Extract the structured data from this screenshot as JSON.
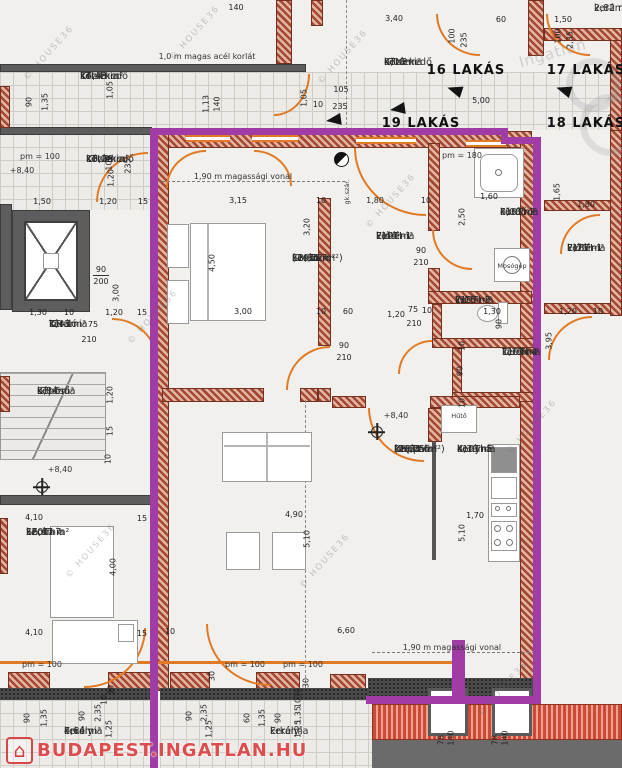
{
  "colors": {
    "purple": "#a13ba5",
    "wall_brick": "#a34832",
    "door_orange": "#e07a25",
    "banner_red": "#d52626"
  },
  "watermarks": {
    "house36": {
      "text": "© HOUSE36",
      "positions": [
        {
          "x": 14,
          "y": 48
        },
        {
          "x": 160,
          "y": 28
        },
        {
          "x": 308,
          "y": 52
        },
        {
          "x": 356,
          "y": 196
        },
        {
          "x": 118,
          "y": 312
        },
        {
          "x": 497,
          "y": 422
        },
        {
          "x": 56,
          "y": 546
        },
        {
          "x": 290,
          "y": 556
        },
        {
          "x": 468,
          "y": 684
        }
      ]
    },
    "portal": {
      "text": "Ingatlan"
    },
    "banner": {
      "icon": "⌂",
      "text": "BUDAPEST.INGATLAN.HU"
    }
  },
  "plan": {
    "units": [
      {
        "label": "16 LAKÁS",
        "x": 466,
        "y": 63
      },
      {
        "label": "17 LAKÁS",
        "x": 586,
        "y": 63
      },
      {
        "label": "19 LAKÁS",
        "x": 421,
        "y": 116
      },
      {
        "label": "18 LAKÁS",
        "x": 586,
        "y": 116
      }
    ],
    "rooms": [
      {
        "id": "KTI-4",
        "name": "Közlekedő",
        "mat": "kerámia",
        "area": "14,43 m²",
        "x": 80,
        "y": 70
      },
      {
        "id": "KTI-2",
        "name": "Közlekedő",
        "mat": "kerámia",
        "area": "10,28 m²",
        "x": 86,
        "y": 153
      },
      {
        "id": "KTI-3",
        "name": "Közlekedő",
        "mat": "kerámia",
        "area": "6,00 m²",
        "x": 384,
        "y": 56
      },
      {
        "id": "KTI-1",
        "name": "Tároló",
        "mat": "kerámia",
        "area": "1,43 m²",
        "x": 49,
        "y": 318
      },
      {
        "id": "KTI-6",
        "name": "Lépcső",
        "mat": "kerámia",
        "area": "6,84 m²",
        "x": 37,
        "y": 385
      },
      {
        "id": "L19TI-7",
        "name": "Szoba",
        "mat": "kerámia",
        "area": "13,36 m²",
        "area2": "(14,22 m²)",
        "x": 292,
        "y": 252
      },
      {
        "id": "L19TI-1",
        "name": "Előtér",
        "mat": "kerámia",
        "area": "7,44 m²",
        "x": 376,
        "y": 230
      },
      {
        "id": "L19TI-2",
        "name": "Fürdő",
        "mat": "kerámia",
        "area": "4,00 m²",
        "x": 500,
        "y": 206
      },
      {
        "id": "L19TI-3",
        "name": "WC",
        "mat": "kerámia",
        "area": "1,15 m²",
        "x": 455,
        "y": 294
      },
      {
        "id": "L19TI-4",
        "name": "Tároló",
        "mat": "kerámia",
        "area": "1,17 m²",
        "x": 502,
        "y": 346
      },
      {
        "id": "L19TI-6",
        "name": "Nappali",
        "mat": "kerámia",
        "area": "28,22 m²",
        "area2": "(29,25 m²)",
        "x": 394,
        "y": 443
      },
      {
        "id": "L19TI-5",
        "name": "Konyha",
        "mat": "kerámia",
        "area": "4,39 m²",
        "x": 457,
        "y": 443
      },
      {
        "id": "L18TI-1",
        "name": "Előtér",
        "mat": "kerámia",
        "area": "7,71 m²",
        "x": 567,
        "y": 242
      },
      {
        "id": "L20TI-7",
        "name": "Szoba",
        "mat": "kerámia",
        "area": "16,47 m²",
        "x": 26,
        "y": 526
      },
      {
        "name": "Erkély",
        "mat": "kerámia",
        "area": "4,64 m²",
        "x": 64,
        "y": 725
      },
      {
        "name": "Erkély",
        "mat": "kerámia",
        "x": 270,
        "y": 725
      },
      {
        "mat": "kerámia",
        "area": "2,82 m²",
        "x": 594,
        "y": 2
      }
    ],
    "notes": [
      {
        "text": "1,0 m magas acél korlát",
        "x": 207,
        "y": 52
      },
      {
        "text": "1,90 m magassági vonal",
        "x": 243,
        "y": 172
      },
      {
        "text": "1,90 m magassági vonal",
        "x": 452,
        "y": 643
      },
      {
        "text": "pm = 100",
        "x": 40,
        "y": 152
      },
      {
        "text": "+8,40",
        "x": 22,
        "y": 166
      },
      {
        "text": "+8,40",
        "x": 60,
        "y": 465
      },
      {
        "text": "+8,40",
        "x": 396,
        "y": 411
      },
      {
        "text": "pm = 180",
        "x": 462,
        "y": 151
      },
      {
        "text": "pm = 100",
        "x": 42,
        "y": 660
      },
      {
        "text": "pm = 100",
        "x": 245,
        "y": 660
      },
      {
        "text": "pm = 100",
        "x": 303,
        "y": 660
      },
      {
        "text": "Hűtő",
        "x": 459,
        "y": 412,
        "small": true
      },
      {
        "text": "Mosógép",
        "x": 512,
        "y": 262,
        "small": true
      },
      {
        "text": "gk.szár.",
        "x": 347,
        "y": 192,
        "small": true,
        "vertical": true
      }
    ],
    "dims": [
      {
        "t": "140",
        "x": 236,
        "y": 3
      },
      {
        "t": "3,40",
        "x": 394,
        "y": 14
      },
      {
        "t": "60",
        "x": 501,
        "y": 15
      },
      {
        "t": "1,50",
        "x": 563,
        "y": 15
      },
      {
        "t": "100",
        "x": 452,
        "y": 36,
        "v": 1
      },
      {
        "t": "235",
        "x": 464,
        "y": 40,
        "v": 1
      },
      {
        "t": "100",
        "x": 558,
        "y": 36,
        "v": 1
      },
      {
        "t": "2,35",
        "x": 570,
        "y": 40,
        "v": 1
      },
      {
        "t": "90",
        "x": 29,
        "y": 102,
        "v": 1
      },
      {
        "t": "1,35",
        "x": 45,
        "y": 102,
        "v": 1
      },
      {
        "t": "1,05",
        "x": 110,
        "y": 90,
        "v": 1
      },
      {
        "t": "1,13",
        "x": 206,
        "y": 104,
        "v": 1
      },
      {
        "t": "140",
        "x": 217,
        "y": 104,
        "v": 1
      },
      {
        "t": "1,05",
        "x": 304,
        "y": 98,
        "v": 1
      },
      {
        "t": "105",
        "x": 341,
        "y": 85
      },
      {
        "t": "10",
        "x": 318,
        "y": 100
      },
      {
        "t": "235",
        "x": 340,
        "y": 102
      },
      {
        "t": "5,00",
        "x": 481,
        "y": 96
      },
      {
        "t": "1,50",
        "x": 42,
        "y": 197
      },
      {
        "t": "1,20",
        "x": 108,
        "y": 197
      },
      {
        "t": "15",
        "x": 143,
        "y": 197
      },
      {
        "t": "100",
        "x": 109,
        "y": 163,
        "v": 1
      },
      {
        "t": "1,20",
        "x": 111,
        "y": 178,
        "v": 1
      },
      {
        "t": "235",
        "x": 128,
        "y": 166,
        "v": 1
      },
      {
        "t": "90",
        "x": 101,
        "y": 265
      },
      {
        "t": "200",
        "x": 101,
        "y": 277
      },
      {
        "t": "3,00",
        "x": 116,
        "y": 293,
        "v": 1
      },
      {
        "t": "1,30",
        "x": 38,
        "y": 308
      },
      {
        "t": "10",
        "x": 69,
        "y": 308
      },
      {
        "t": "1,20",
        "x": 114,
        "y": 308
      },
      {
        "t": "15",
        "x": 142,
        "y": 308
      },
      {
        "t": "75",
        "x": 93,
        "y": 320
      },
      {
        "t": "210",
        "x": 89,
        "y": 335
      },
      {
        "t": "1,20",
        "x": 110,
        "y": 395,
        "v": 1
      },
      {
        "t": "15",
        "x": 110,
        "y": 431,
        "v": 1
      },
      {
        "t": "10",
        "x": 108,
        "y": 459,
        "v": 1
      },
      {
        "t": "4,10",
        "x": 34,
        "y": 513
      },
      {
        "t": "15",
        "x": 142,
        "y": 514
      },
      {
        "t": "4,00",
        "x": 113,
        "y": 567,
        "v": 1
      },
      {
        "t": "4,10",
        "x": 34,
        "y": 628
      },
      {
        "t": "15",
        "x": 142,
        "y": 629
      },
      {
        "t": "3,15",
        "x": 238,
        "y": 196
      },
      {
        "t": "10",
        "x": 321,
        "y": 196
      },
      {
        "t": "3,20",
        "x": 307,
        "y": 227,
        "v": 1
      },
      {
        "t": "4,50",
        "x": 212,
        "y": 263,
        "v": 1
      },
      {
        "t": "3,00",
        "x": 243,
        "y": 307
      },
      {
        "t": "10",
        "x": 321,
        "y": 307
      },
      {
        "t": "60",
        "x": 348,
        "y": 307
      },
      {
        "t": "1,80",
        "x": 375,
        "y": 196
      },
      {
        "t": "10",
        "x": 426,
        "y": 196
      },
      {
        "t": "2,50",
        "x": 462,
        "y": 217,
        "v": 1
      },
      {
        "t": "1,60",
        "x": 489,
        "y": 192
      },
      {
        "t": "90",
        "x": 421,
        "y": 246
      },
      {
        "t": "210",
        "x": 421,
        "y": 258
      },
      {
        "t": "90",
        "x": 344,
        "y": 341
      },
      {
        "t": "210",
        "x": 344,
        "y": 353
      },
      {
        "t": "1,20",
        "x": 396,
        "y": 310
      },
      {
        "t": "75",
        "x": 413,
        "y": 305
      },
      {
        "t": "10",
        "x": 427,
        "y": 306
      },
      {
        "t": "210",
        "x": 414,
        "y": 319
      },
      {
        "t": "1,30",
        "x": 492,
        "y": 307
      },
      {
        "t": "90",
        "x": 499,
        "y": 324,
        "v": 1
      },
      {
        "t": "10",
        "x": 462,
        "y": 346,
        "v": 1
      },
      {
        "t": "90",
        "x": 460,
        "y": 371,
        "v": 1
      },
      {
        "t": "10",
        "x": 462,
        "y": 403,
        "v": 1
      },
      {
        "t": "1,65",
        "x": 557,
        "y": 192,
        "v": 1
      },
      {
        "t": "1,80",
        "x": 586,
        "y": 200
      },
      {
        "t": "1,20",
        "x": 568,
        "y": 307
      },
      {
        "t": "10",
        "x": 598,
        "y": 307
      },
      {
        "t": "3,95",
        "x": 549,
        "y": 341,
        "v": 1
      },
      {
        "t": "1,70",
        "x": 475,
        "y": 511
      },
      {
        "t": "5,10",
        "x": 462,
        "y": 533,
        "v": 1
      },
      {
        "t": "4,90",
        "x": 294,
        "y": 510
      },
      {
        "t": "5,10",
        "x": 307,
        "y": 539,
        "v": 1
      },
      {
        "t": "6,60",
        "x": 346,
        "y": 626
      },
      {
        "t": "10",
        "x": 170,
        "y": 627
      },
      {
        "t": "30",
        "x": 212,
        "y": 676,
        "v": 1
      },
      {
        "t": "30",
        "x": 306,
        "y": 683,
        "v": 1
      },
      {
        "t": "90",
        "x": 27,
        "y": 718,
        "v": 1
      },
      {
        "t": "1,35",
        "x": 44,
        "y": 718,
        "v": 1
      },
      {
        "t": "90",
        "x": 82,
        "y": 716,
        "v": 1
      },
      {
        "t": "2,35",
        "x": 98,
        "y": 713,
        "v": 1
      },
      {
        "t": "10",
        "x": 104,
        "y": 700,
        "v": 1
      },
      {
        "t": "1,25",
        "x": 109,
        "y": 729,
        "v": 1
      },
      {
        "t": "30",
        "x": 111,
        "y": 690,
        "v": 1
      },
      {
        "t": "90",
        "x": 189,
        "y": 716,
        "v": 1
      },
      {
        "t": "2,35",
        "x": 204,
        "y": 713,
        "v": 1
      },
      {
        "t": "1,25",
        "x": 209,
        "y": 729,
        "v": 1
      },
      {
        "t": "60",
        "x": 247,
        "y": 718,
        "v": 1
      },
      {
        "t": "1,35",
        "x": 262,
        "y": 718,
        "v": 1
      },
      {
        "t": "90",
        "x": 278,
        "y": 718,
        "v": 1
      },
      {
        "t": "30",
        "x": 298,
        "y": 693,
        "v": 1
      },
      {
        "t": "10",
        "x": 298,
        "y": 703,
        "v": 1
      },
      {
        "t": "1,35",
        "x": 298,
        "y": 715,
        "v": 1
      },
      {
        "t": "1,25",
        "x": 298,
        "y": 729,
        "v": 1
      },
      {
        "t": "78",
        "x": 441,
        "y": 740,
        "v": 1
      },
      {
        "t": "140",
        "x": 451,
        "y": 738,
        "v": 1
      },
      {
        "t": "78",
        "x": 495,
        "y": 740,
        "v": 1
      },
      {
        "t": "140",
        "x": 505,
        "y": 738,
        "v": 1
      }
    ]
  }
}
